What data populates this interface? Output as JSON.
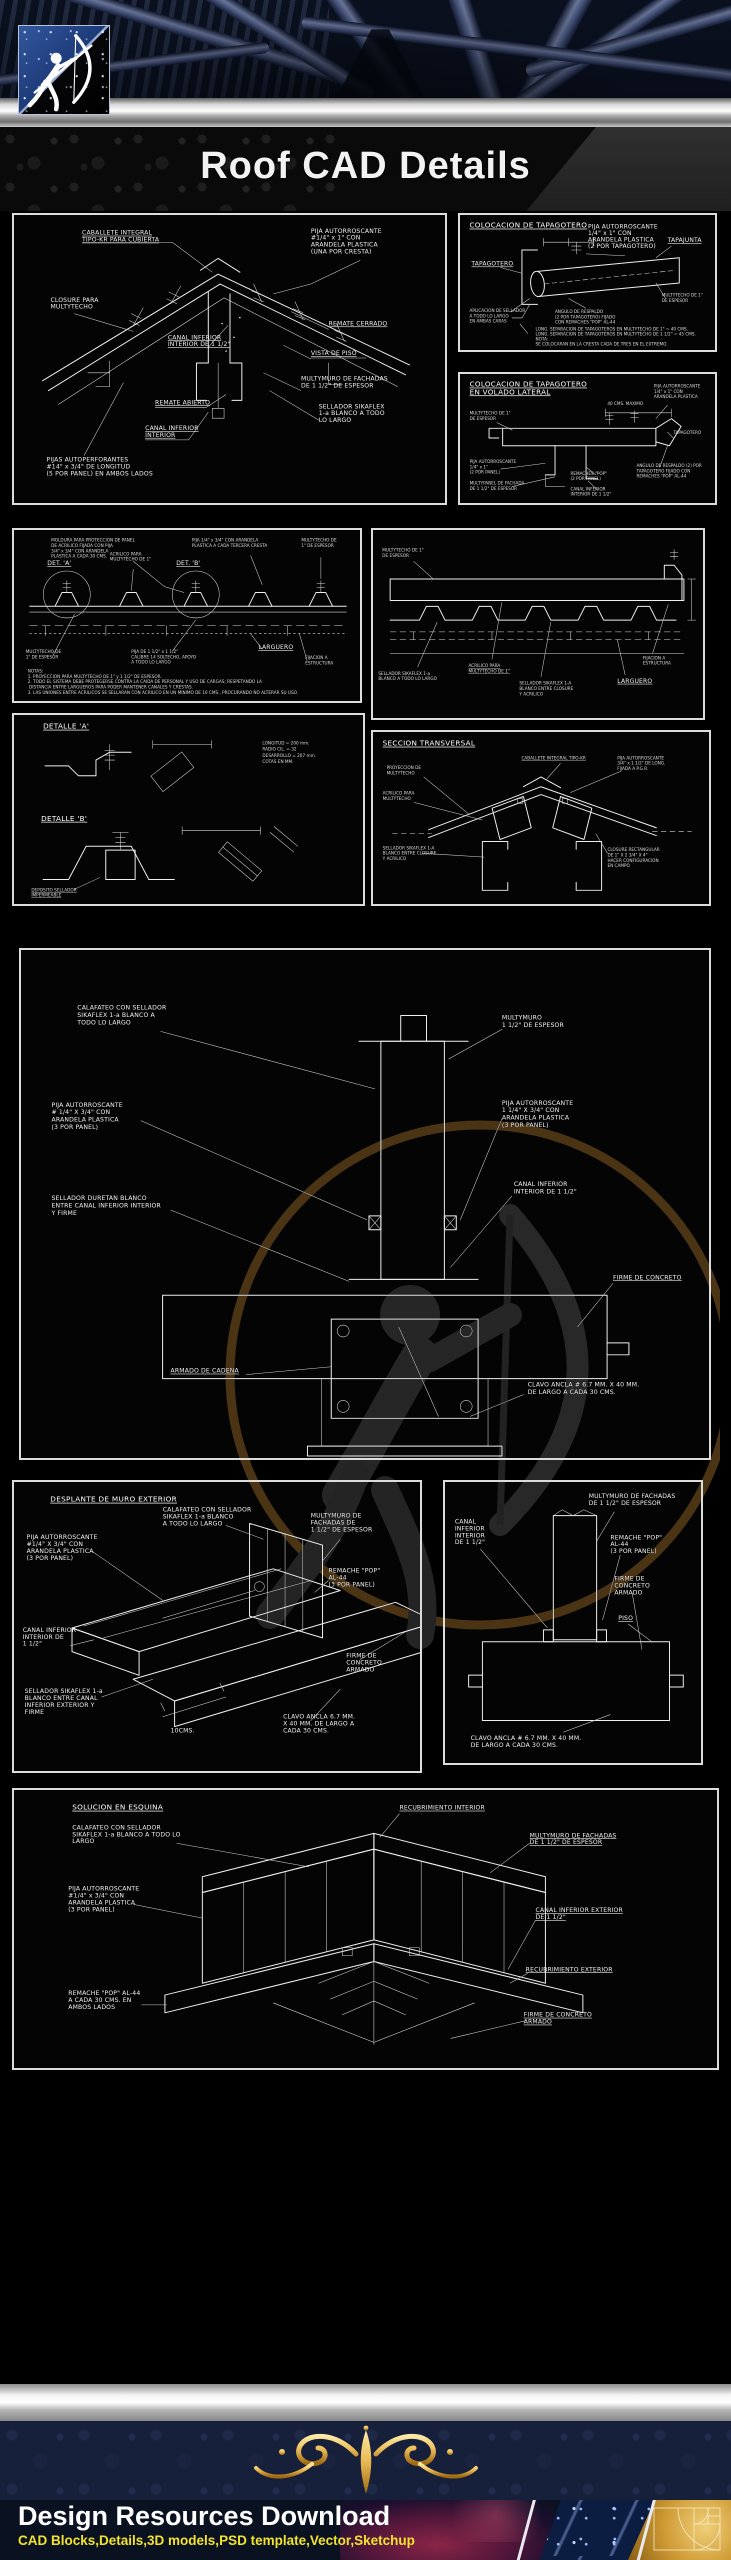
{
  "header": {
    "title": "Roof CAD Details"
  },
  "footer": {
    "title": "Design Resources Download",
    "subtitle": "CAD Blocks,Details,3D models,PSD template,Vector,Sketchup"
  },
  "colors": {
    "accent_gold": "#edbf5a",
    "footer_yellow": "#f2e42e",
    "silver": "#cfcfcf",
    "navy_band": "#17203a",
    "steel_blue": "#8d9cc7",
    "cad_line": "#efefef"
  },
  "panels": {
    "ridge_iso": {
      "labels": {
        "caballete": [
          "CABALLETE INTEGRAL",
          "TIPO-KR PARA CUBIERTA"
        ],
        "pija_cresta": [
          "PIJA AUTORROSCANTE",
          "#1/4\" x 1\" CON",
          "ARANDELA PLASTICA",
          "(UNA POR CRESTA)"
        ],
        "closure": [
          "CLOSURE PARA",
          "MULTYTECHO"
        ],
        "canal_interior": [
          "CANAL INFERIOR",
          "INTERIOR DE 1 1/2\""
        ],
        "remate_cerrado": [
          "REMATE CERRADO"
        ],
        "vista": [
          "VISTA DE PISO"
        ],
        "multymuro": [
          "MULTYMURO DE FACHADAS",
          "DE 1 1/2\" DE ESPESOR"
        ],
        "sellador": [
          "SELLADOR SIKAFLEX",
          "1-a BLANCO A TODO",
          "LO LARGO"
        ],
        "remate_abierto": [
          "REMATE ABIERTO"
        ],
        "canal_inf2": [
          "CANAL INFERIOR",
          "INTERIOR"
        ],
        "pijas_autoperf": [
          "PIJAS AUTOPERFORANTES",
          "#14\" x 3/4\" DE LONGITUD",
          "(5 POR PANEL) EN AMBOS LADOS"
        ]
      }
    },
    "tapagotero": {
      "title": [
        "COLOCACION DE TAPAGOTERO"
      ],
      "labels": {
        "tapagotero": [
          "TAPAGOTERO"
        ],
        "pija": [
          "PIJA AUTORROSCANTE",
          "1/4\" x 1\" CON",
          "ARANDELA PLASTICA",
          "(2 POR TAPAGOTERO)"
        ],
        "tapajunta": [
          "TAPAJUNTA"
        ],
        "aplicacion": [
          "APLICACION DE SELLADOR",
          "A TODO LO LARGO",
          "EN AMBAS CARAS"
        ],
        "angulo": [
          "ANGULO DE RESPALDO",
          "(2 POR TAPAGOTERO) FIJADO",
          "CON REMACHES \"POP\" AL-44"
        ],
        "multytecho": [
          "MULTYTECHO DE 1\"",
          "DE ESPESOR"
        ]
      },
      "notes": [
        "LONG. SEPARACION DE TAPAGOTEROS EN MULTYTECHO DE 1\" = 40 CMS.",
        "LONG. SEPARACION DE TAPAGOTEROS EN MULTYTECHO DE 1 1/2\" = 45 CMS.",
        "NOTA:",
        "SE COLOCARAN EN LA CRESTA CADA DE TRES EN EL EXTREMO."
      ]
    },
    "tapagotero_volado": {
      "title": [
        "COLOCACION DE TAPAGOTERO",
        "EN VOLADO LATERAL"
      ],
      "labels": {
        "multytecho": [
          "MULTYTECHO DE 1\"",
          "DE ESPESOR"
        ],
        "dim": [
          "40 CMS. MAXIMO"
        ],
        "pija": [
          "PIJA AUTORROSCANTE",
          "1/4\" x 1\" CON",
          "ARANDELA PLASTICA"
        ],
        "tapagotero": [
          "TAPAGOTERO"
        ],
        "pija2": [
          "PIJA AUTORROSCANTE",
          "1/4\" x 1\"",
          "(2 POR PANEL)"
        ],
        "multypanel": [
          "MULTYPANEL DE FACHADA",
          "DE 1 1/2\" DE ESPESOR"
        ],
        "remaches": [
          "REMACHES \"POP\"",
          "(2 POR PANEL)"
        ],
        "canal": [
          "CANAL INFERIOR",
          "INTERIOR DE 1 1/2\""
        ],
        "angulo": [
          "ANGULO DE RESPALDO (2) POR",
          "TAPAGOTERO FIJADO CON",
          "REMACHES \"POP\" AL-44"
        ]
      }
    },
    "fijacion_lamina": {
      "labels": {
        "moldura_top": [
          "MOLDURA PARA PROTECCION DE PANEL",
          "DE ACRILICO FIJADA CON PIJA",
          "3/4\" x 3/4\" CON ARANDELA",
          "PLASTICA A CADA 30 CMS."
        ],
        "det_a": [
          "DET. 'A'"
        ],
        "det_b": [
          "DET. 'B'"
        ],
        "pija_cresta": [
          "PIJA 1/4\" x 3/4\" CON ARANDELA",
          "PLASTICA A CADA TERCERA CRESTA"
        ],
        "acrilico": [
          "ACRILICO PARA",
          "MULTYTECHO DE 1\""
        ],
        "mult_tr": [
          "MULTYTECHO DE",
          "1\" DE ESPESOR"
        ],
        "mult_bl": [
          "MULTYTECHO DE",
          "1\" DE ESPESOR"
        ],
        "pija_soporte": [
          "PIJA DE 1 1/2\" x 1 1/2\"",
          "CALIBRE 14 SOLTECHO, APOYO",
          "A TODO LO LARGO"
        ],
        "larguero": [
          "LARGUERO"
        ],
        "fijacion": [
          "FIJACION A",
          "ESTRUCTURA"
        ]
      },
      "notes": [
        "NOTAS:",
        "1. PROYECCION PARA MULTYTECHO DE 1\" y 1 1/2\" DE ESPESOR.",
        "2. TODO EL SISTEMA DEBE PROTEGERSE CONTRA LA CAIDA DE PERSONAL Y USO DE CARGAS; RESPETANDO LA",
        "    DISTANCIA ENTRE LARGUEROS PARA PODER MANTENER CANALES Y CRESTAS.",
        "3. LAS UNIONES ENTRE ACRILICOS SE SELLARAN CON ACRILICO EN UN MINIMO DE 10 CMS., PROCURANDO NO ALTERAR SU USO."
      ]
    },
    "seccion_longitudinal": {
      "labels": {
        "multytecho": [
          "MULTYTECHO DE 1\"",
          "DE ESPESOR"
        ],
        "sellador_left": [
          "SELLADOR SIKAFLEX 1-a",
          "BLANCO A TODO LO LARGO"
        ],
        "acrilico": [
          "ACRILICO PARA",
          "MULTYTECHO DE 1\""
        ],
        "sellador": [
          "SELLADOR SIKAFLEX 1-A",
          "BLANCO ENTRE CLOSURE",
          "Y ACRILICO"
        ],
        "larguero": [
          "LARGUERO"
        ],
        "fijacion": [
          "FIJACION A",
          "ESTRUCTURA"
        ]
      }
    },
    "detalles": {
      "labels": {
        "det_a": [
          "DETALLE 'A'"
        ],
        "dims": [
          "LONGITUD        = 200 mm.",
          "RADIO CIL.        = 32",
          "DESARROLLO   = 207 mm.",
          "COTAS EN MM."
        ],
        "det_b": [
          "DETALLE 'B'"
        ],
        "deposito": [
          "DEPOSITO SELLADOR",
          "IMPERMEABLE"
        ]
      }
    },
    "seccion_transversal": {
      "title": [
        "SECCION TRANSVERSAL"
      ],
      "labels": {
        "proyeccion": [
          "PROYECCION DE",
          "MULTYTECHO"
        ],
        "acrilico": [
          "ACRILICO PARA",
          "MULTYTECHO"
        ],
        "sellador": [
          "SELLADOR SIKAFLEX 1-A",
          "BLANCO ENTRE CLOSURE",
          "Y ACRILICO"
        ],
        "caballete": [
          "CABALLETE INTEGRAL TIPO-KR"
        ],
        "pija": [
          "PIJA AUTORROSCANTE",
          "3/4\" x 1 1/2\" DE LONG.",
          "FIJADA A P.G.R."
        ],
        "closure": [
          "CLOSURE RECTANGULAR",
          "DE 1\" X 2 3/4\" X 4\"",
          "HACER CONFIGURACION",
          "EN CAMPO"
        ]
      }
    },
    "muro_firme": {
      "labels": {
        "calafateo": [
          "CALAFATEO CON SELLADOR",
          "SIKAFLEX 1-a BLANCO A",
          "TODO LO LARGO"
        ],
        "multymuro": [
          "MULTYMURO",
          "1 1/2\" DE ESPESOR"
        ],
        "pija_izq": [
          "PIJA AUTORROSCANTE",
          "# 1/4\" X 3/4\" CON",
          "ARANDELA PLASTICA",
          "(3 POR PANEL)"
        ],
        "pija_der": [
          "PIJA AUTORROSCANTE",
          "1 1/4\" X 3/4\" CON",
          "ARANDELA PLASTICA",
          "(3 POR PANEL)"
        ],
        "sellador": [
          "SELLADOR DURETAN BLANCO",
          "ENTRE CANAL INFERIOR INTERIOR",
          "Y FIRME"
        ],
        "canal": [
          "CANAL INFERIOR",
          "INTERIOR DE 1 1/2\""
        ],
        "firme": [
          "FIRME DE CONCRETO"
        ],
        "armado": [
          "ARMADO DE CADENA"
        ],
        "clavo": [
          "CLAVO ANCLA # 6.7 MM. X 40 MM.",
          "DE LARGO A CADA 30 CMS."
        ]
      }
    },
    "desplante_muro": {
      "title": [
        "DESPLANTE DE MURO EXTERIOR"
      ],
      "labels": {
        "calafateo": [
          "CALAFATEO CON SELLADOR",
          "SIKAFLEX 1-a BLANCO",
          "A TODO LO LARGO"
        ],
        "pija": [
          "PIJA AUTORROSCANTE",
          "#1/4\" X 3/4\" CON",
          "ARANDELA PLASTICA",
          "(3 POR PANEL)"
        ],
        "multymuro": [
          "MULTYMURO DE",
          "FACHADAS DE",
          "1 1/2\" DE ESPESOR"
        ],
        "remache": [
          "REMACHE \"POP\"",
          "AL-44",
          "(3 POR PANEL)"
        ],
        "canal": [
          "CANAL INFERIOR",
          "INTERIOR DE",
          "1 1/2\""
        ],
        "firme": [
          "FIRME DE",
          "CONCRETO",
          "ARMADO"
        ],
        "sellador": [
          "SELLADOR SIKAFLEX 1-a",
          "BLANCO ENTRE CANAL",
          "INFERIOR EXTERIOR Y",
          "FIRME"
        ],
        "clavo": [
          "CLAVO ANCLA 6.7 MM.",
          "X 40 MM. DE LARGO A",
          "CADA 30 CMS."
        ],
        "dim": [
          "10CMS."
        ]
      }
    },
    "muro_base": {
      "labels": {
        "multymuro": [
          "MULTYMURO DE FACHADAS",
          "DE 1 1/2\" DE ESPESOR"
        ],
        "canal": [
          "CANAL",
          "INFERIOR",
          "INTERIOR",
          "DE 1 1/2\""
        ],
        "remache": [
          "REMACHE \"POP\"",
          "AL-44",
          "(3 POR PANEL)"
        ],
        "firme": [
          "FIRME DE",
          "CONCRETO",
          "ARMADO"
        ],
        "piso": [
          "PISO"
        ],
        "clavo": [
          "CLAVO ANCLA # 6.7 MM. X 40 MM.",
          "DE LARGO A CADA 30 CMS."
        ]
      }
    },
    "esquina": {
      "title": [
        "SOLUCION EN ESQUINA"
      ],
      "labels": {
        "calafateo": [
          "CALAFATEO CON SELLADOR",
          "SIKAFLEX 1-a BLANCO A TODO LO",
          "LARGO"
        ],
        "pija": [
          "PIJA AUTORROSCANTE",
          "#1/4\" x 3/4\" CON",
          "ARANDELA PLASTICA",
          "(3 POR PANEL)"
        ],
        "remache": [
          "REMACHE \"POP\" AL-44",
          "A CADA 30 CMS. EN",
          "AMBOS LADOS"
        ],
        "recub_int": [
          "RECUBRIMIENTO INTERIOR"
        ],
        "multymuro": [
          "MULTYMURO DE FACHADAS",
          "DE 1 1/2\" DE ESPESOR"
        ],
        "canal": [
          "CANAL INFERIOR EXTERIOR",
          "DE 1 1/2\""
        ],
        "recub_ext": [
          "RECUBRIMIENTO EXTERIOR"
        ],
        "firme": [
          "FIRME DE CONCRETO",
          "ARMADO"
        ]
      }
    }
  }
}
